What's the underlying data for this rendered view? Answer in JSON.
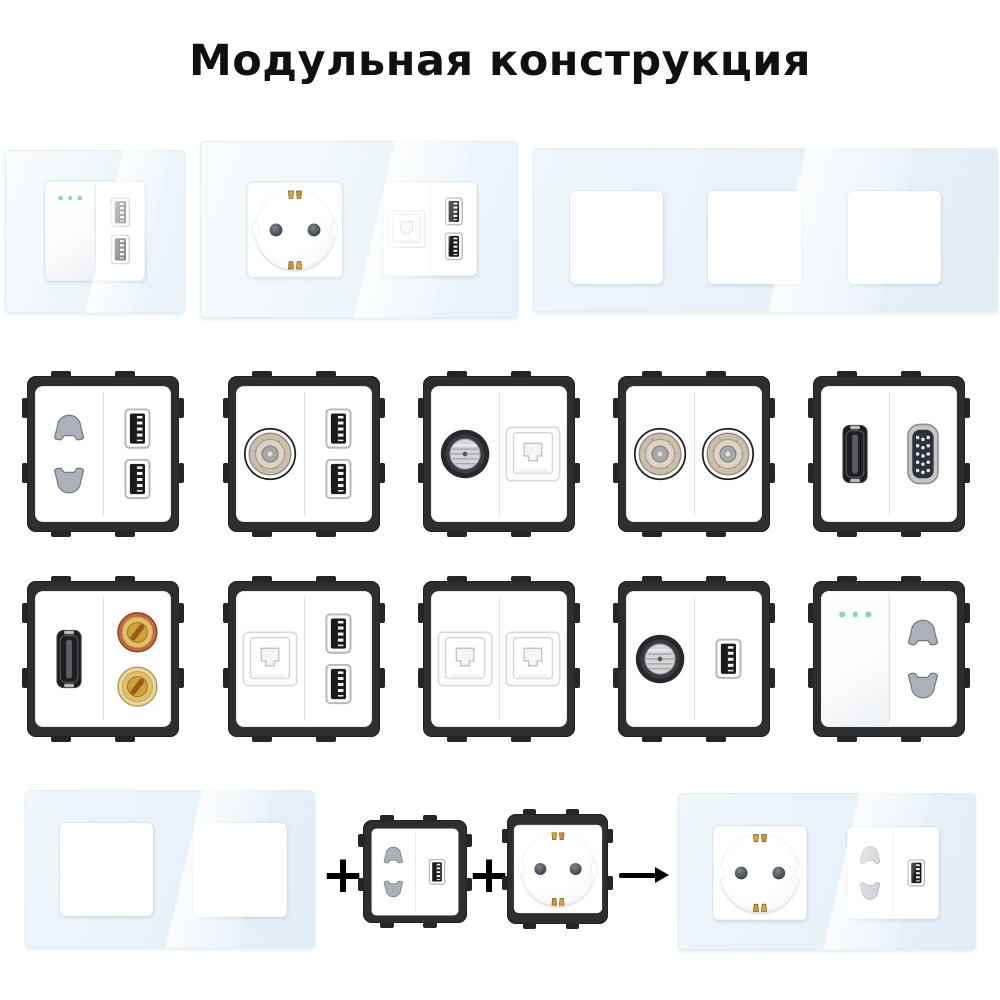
{
  "title": "Модульная конструкция",
  "palette": {
    "background": "#ffffff",
    "title_color": "#101010",
    "glass_tint": "#e9f2f8",
    "module_frame": "#2c2e30",
    "device_face": "#ffffff",
    "led_green": "#84d9ab",
    "clip_gold": "#d8a63e",
    "symbol_black": "#000000"
  },
  "top_row": [
    {
      "name": "glass-panel-1gang-switch-dual-usb",
      "gangs": 1,
      "devices": [
        [
          "switch",
          "usb2"
        ]
      ]
    },
    {
      "name": "glass-panel-2gang-schuko-ethernet-dual-usb",
      "gangs": 2,
      "devices": [
        [
          "schuko"
        ],
        [
          "rj45",
          "usb2"
        ]
      ]
    },
    {
      "name": "glass-panel-3gang-empty",
      "gangs": 3,
      "devices": [
        null,
        null,
        null
      ]
    }
  ],
  "module_grid": [
    [
      [
        "pin2",
        "usb2"
      ],
      [
        "tv",
        "usb2"
      ],
      [
        "sat",
        "rj45"
      ],
      [
        "tv",
        "tv"
      ],
      [
        "hdmi",
        "vga"
      ]
    ],
    [
      [
        "hdmi",
        "audio2"
      ],
      [
        "rj45",
        "usb2"
      ],
      [
        "rj45",
        "rj45"
      ],
      [
        "sat",
        "usb"
      ],
      [
        "switch",
        "pin2"
      ]
    ]
  ],
  "assembly": {
    "frame": {
      "name": "glass-panel-2gang-empty",
      "gangs": 2,
      "devices": [
        null,
        null
      ]
    },
    "plus1": "+",
    "module_a": [
      "pin2",
      "usb"
    ],
    "plus2": "+",
    "module_b": [
      "schuko"
    ],
    "arrow_icon": "right-arrow",
    "result": {
      "name": "glass-panel-2gang-schuko-pin2-usb",
      "gangs": 2,
      "devices": [
        [
          "schuko"
        ],
        [
          "pin2",
          "usb"
        ]
      ]
    }
  },
  "port_legend": {
    "switch": "rocker-switch-with-led-dots",
    "usb": "usb-a-port",
    "usb2": "dual-usb-a-ports",
    "pin2": "two-pin-socket",
    "schuko": "eu-schuko-socket",
    "tv": "tv-antenna-socket",
    "sat": "satellite-f-connector",
    "rj45": "ethernet-rj45-socket",
    "hdmi": "hdmi-port",
    "vga": "vga-port",
    "audio2": "audio-binding-posts"
  }
}
